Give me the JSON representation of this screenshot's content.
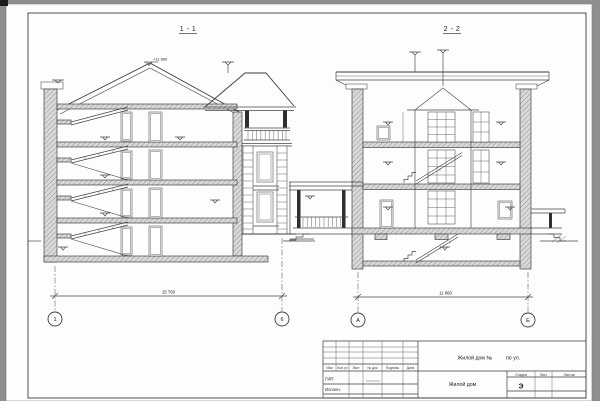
{
  "colors": {
    "background": "#8e8e8e",
    "paper": "#fdfdfd",
    "ink": "#3c3c3c",
    "hatch_fill": "#d9d9d9"
  },
  "sections": {
    "left": {
      "title": "1 - 1",
      "dimension": "15 760",
      "axis_left": "1",
      "axis_right": "6",
      "elevation_mark": "+11.660"
    },
    "right": {
      "title": "2 - 2",
      "dimension": "11 960",
      "axis_left": "А",
      "axis_right": "Е"
    }
  },
  "title_block": {
    "project_title_part1": "Жилой дом №",
    "project_title_part2": "по ул.",
    "object_name": "Жилой дом",
    "columns": {
      "izm": "Изм",
      "koluch": "Кол.уч",
      "list": "Лист",
      "ndoc": "№ док",
      "podpis": "Подпись",
      "data": "Дата"
    },
    "roles": {
      "gip": "ГИП",
      "ispoln": "Исполн."
    },
    "stage_header": "Стадия",
    "sheet_header": "Лист",
    "sheets_header": "Листов",
    "stage_value": "Э"
  }
}
